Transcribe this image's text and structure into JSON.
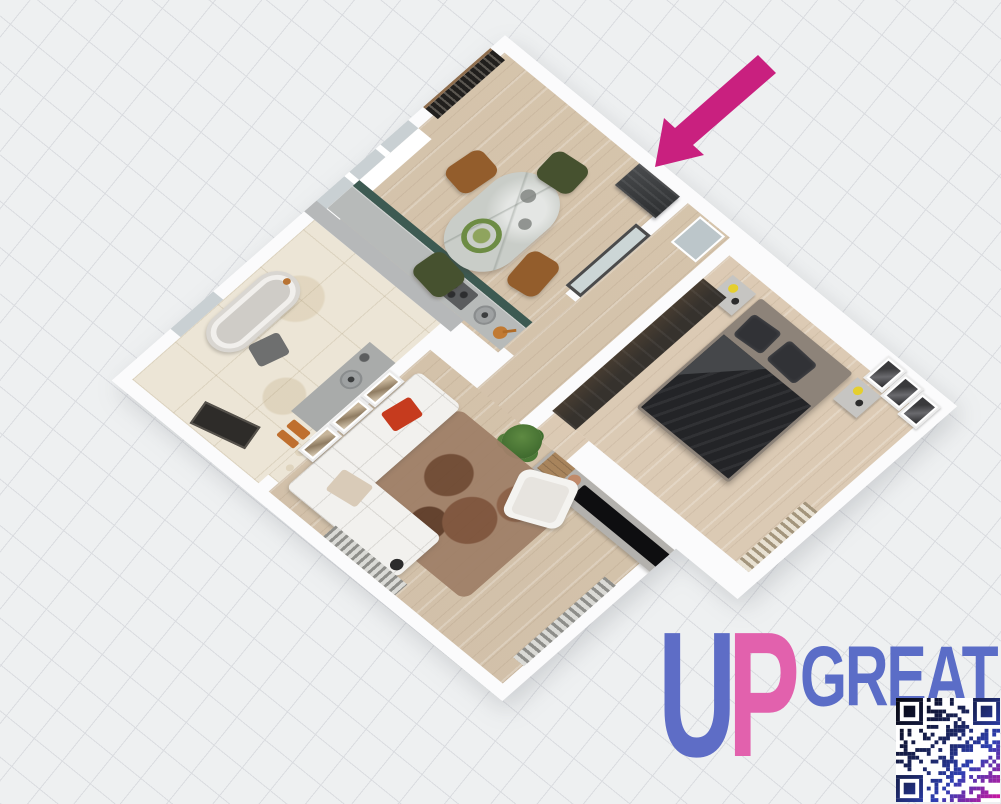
{
  "watermark": {
    "logo_u": "U",
    "logo_p": "P",
    "logo_rest": "GREAT",
    "colors": {
      "u": "#5e6dc6",
      "p": "#e261ad",
      "rest": "#5b6dc7"
    }
  },
  "annotation_arrow": {
    "color": "#c9207f",
    "direction": "pointing-down-left",
    "points_to": "dark wall panel at apartment entrance"
  },
  "qr_code": {
    "present": true,
    "gradient": [
      "#07070e",
      "#1b2660",
      "#2e3fb3",
      "#d8149e"
    ]
  },
  "canvas": {
    "background": "#eef0f1",
    "grid_line_color": "#dadce0",
    "grid_spacing_px": 36,
    "grid_rotation_deg": 39
  },
  "floor_plan": {
    "type": "3d-top-down-apartment-render",
    "rotation_deg": 39,
    "wall_color": "#fbfbfc",
    "rooms": [
      {
        "name": "kitchen-dining",
        "floor": "light-oak-wood",
        "furniture": [
          "louvered-entrance-door",
          "window-strip-3-panes",
          "kitchen-counter-gray",
          "kitchen-cabinet-front-teal",
          "hob",
          "round-sink",
          "copper-pan",
          "marble-dining-table",
          "green-wreath-centerpiece",
          "chair-green-top",
          "chair-green-bottom",
          "chair-brown-left",
          "chair-brown-right"
        ]
      },
      {
        "name": "hallway",
        "floor": "light-oak-wood",
        "furniture": [
          "glass-door-dark-frame",
          "dark-wall-panel",
          "wall-mirror"
        ]
      },
      {
        "name": "bedroom",
        "floor": "pale-oak-wood",
        "furniture": [
          "double-bed-dark-bedding",
          "nightstand-left",
          "nightstand-right",
          "table-lamp-yellow-x2",
          "wall-frame-x3",
          "dark-wardrobe",
          "radiator-beige"
        ]
      },
      {
        "name": "living-room",
        "floor": "light-oak-wood",
        "furniture": [
          "corner-sofa-white",
          "red-pillow",
          "tan-throw",
          "brown-rug",
          "white-armchair",
          "tv-sideboard-gray",
          "flat-tv-black",
          "wooden-crate",
          "round-trays",
          "speaker",
          "potted-plant",
          "wall-frame-x3",
          "radiator-right",
          "radiator-bottom",
          "floor-lamp"
        ]
      },
      {
        "name": "bathroom",
        "floor": "beige-marble-tile",
        "furniture": [
          "freestanding-bathtub",
          "vanity-with-round-sink",
          "orange-towels",
          "dark-door-leaf",
          "bath-stool",
          "small-window"
        ]
      }
    ],
    "colors": {
      "wood_floor": "#d8c7b0",
      "marble_floor": "#ece5d6",
      "kitchen_teal": "#3d5a52",
      "bed_dark": "#232427",
      "sofa_white": "#f2f1ee",
      "red_pillow": "#c63b1e",
      "wardrobe_dark": "#36322d"
    }
  }
}
